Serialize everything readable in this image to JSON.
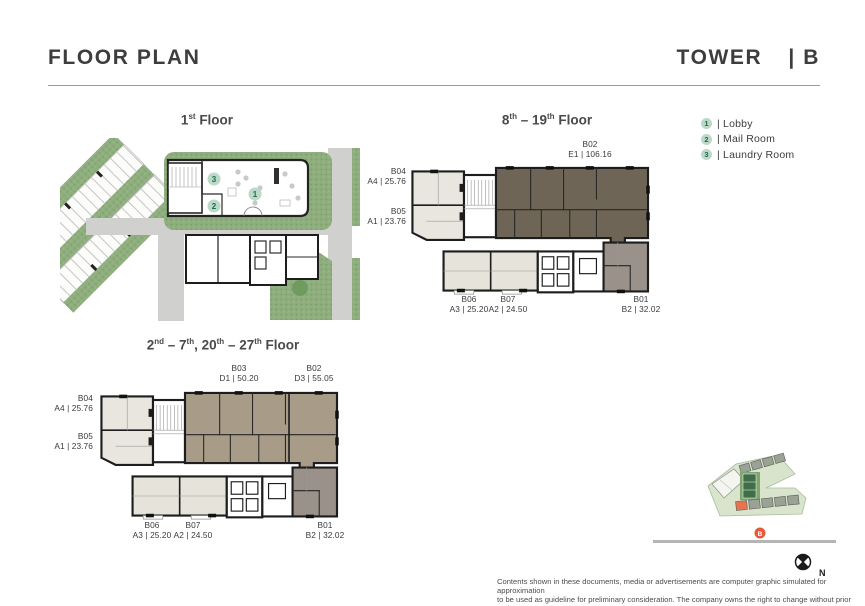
{
  "header": {
    "title": "FLOOR PLAN",
    "tower": "TOWER",
    "unit": "| B"
  },
  "plans": {
    "first": {
      "title": [
        {
          "t": "1"
        },
        {
          "s": "st"
        },
        {
          "t": " Floor"
        }
      ],
      "markers": [
        "1",
        "2",
        "3"
      ]
    },
    "high": {
      "title": [
        {
          "t": "8"
        },
        {
          "s": "th"
        },
        {
          "t": " – 19"
        },
        {
          "s": "th"
        },
        {
          "t": "  Floor"
        }
      ],
      "units": [
        {
          "name": "B02",
          "spec": "E1 | 106.16"
        },
        {
          "name": "B04",
          "spec": "A4 | 25.76"
        },
        {
          "name": "B05",
          "spec": "A1 | 23.76"
        },
        {
          "name": "B06",
          "spec": "A3 | 25.20"
        },
        {
          "name": "B07",
          "spec": "A2 | 24.50"
        },
        {
          "name": "B01",
          "spec": "B2 | 32.02"
        }
      ]
    },
    "mid": {
      "title": [
        {
          "t": "2"
        },
        {
          "s": "nd"
        },
        {
          "t": " – 7"
        },
        {
          "s": "th"
        },
        {
          "t": ", 20"
        },
        {
          "s": "th"
        },
        {
          "t": " – 27"
        },
        {
          "s": "th"
        },
        {
          "t": " Floor"
        }
      ],
      "units": [
        {
          "name": "B03",
          "spec": "D1 | 50.20"
        },
        {
          "name": "B02",
          "spec": "D3 | 55.05"
        },
        {
          "name": "B04",
          "spec": "A4 | 25.76"
        },
        {
          "name": "B05",
          "spec": "A1 | 23.76"
        },
        {
          "name": "B06",
          "spec": "A3 | 25.20"
        },
        {
          "name": "B07",
          "spec": "A2 | 24.50"
        },
        {
          "name": "B01",
          "spec": "B2 | 32.02"
        }
      ]
    }
  },
  "legend": [
    {
      "num": "1",
      "label": "| Lobby"
    },
    {
      "num": "2",
      "label": "| Mail Room"
    },
    {
      "num": "3",
      "label": "| Laundry Room"
    }
  ],
  "sitemap": {
    "marker": "B"
  },
  "compass": {
    "label": "N"
  },
  "disclaimer": {
    "line1": "Contents  shown in these documents, media or advertisements are computer graphic simulated for approximation",
    "line2": "to be used as guideline for preliminary consideration. The company owns the right to change without prior notice"
  },
  "colors": {
    "accent_green_badge": "#bcd9c7",
    "accent_green_text": "#1d6b55",
    "unit_dark_brown": "#6f6557",
    "unit_taupe": "#a89b88",
    "unit_beige": "#e9e6df",
    "unit_gray": "#99918a",
    "landscape_green": "#8fae7e",
    "road_gray": "#d0d0cf",
    "highlight_orange": "#e2593b",
    "text_dark": "#3d3d3d"
  }
}
